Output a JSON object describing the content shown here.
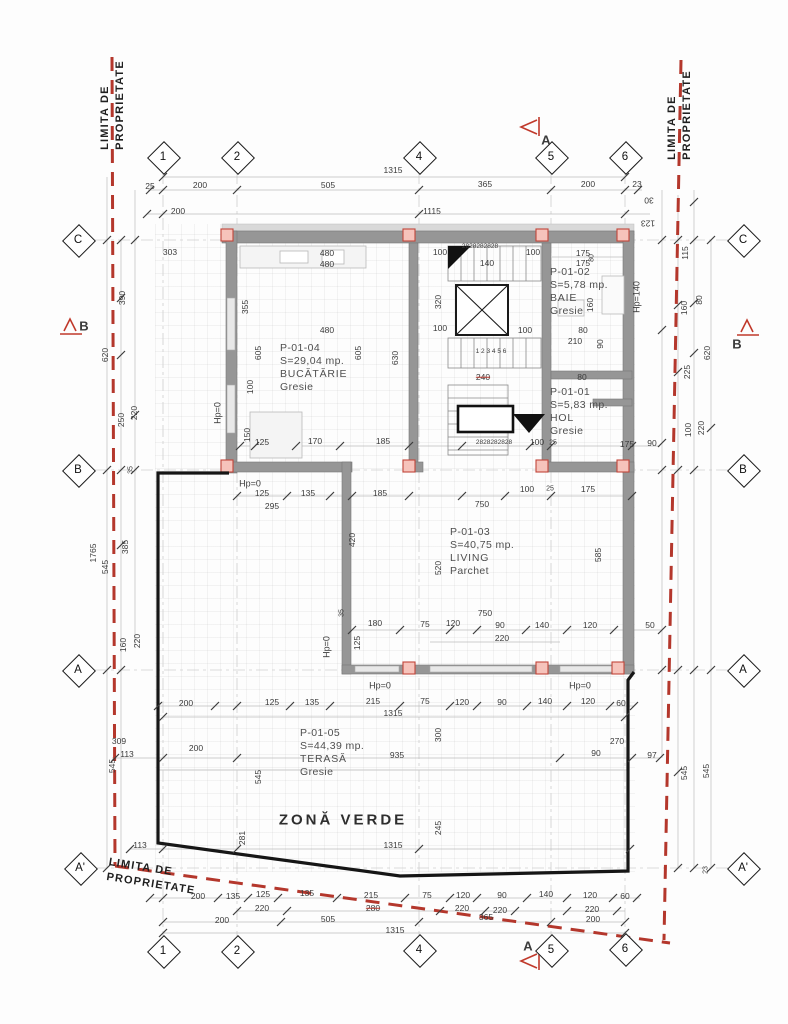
{
  "title": "floor-plan",
  "colors": {
    "property_line": "#b4372c",
    "section_marker": "#c0392b",
    "wall": "#969696",
    "column_fill": "#f6c3bb",
    "outline": "#161616"
  },
  "property_labels": [
    {
      "lines": [
        "LIMITA DE",
        "PROPRIETATE"
      ],
      "x": 113,
      "y": 105,
      "rot": -90,
      "name": "property-line-label-top-left"
    },
    {
      "lines": [
        "LIMITA DE",
        "PROPRIETATE"
      ],
      "x": 680,
      "y": 115,
      "rot": -90,
      "name": "property-line-label-top-right"
    },
    {
      "lines": [
        "LIMITA DE",
        "PROPRIETATE"
      ],
      "x": 152,
      "y": 877,
      "rot": 9,
      "name": "property-line-label-bottom-left"
    }
  ],
  "grid_bubbles": [
    {
      "id": "1",
      "x": 163,
      "y": 157,
      "pos": "top"
    },
    {
      "id": "2",
      "x": 237,
      "y": 157,
      "pos": "top"
    },
    {
      "id": "4",
      "x": 419,
      "y": 157,
      "pos": "top"
    },
    {
      "id": "5",
      "x": 551,
      "y": 157,
      "pos": "top"
    },
    {
      "id": "6",
      "x": 625,
      "y": 157,
      "pos": "top"
    },
    {
      "id": "1",
      "x": 163,
      "y": 951,
      "pos": "bottom"
    },
    {
      "id": "2",
      "x": 237,
      "y": 951,
      "pos": "bottom"
    },
    {
      "id": "4",
      "x": 419,
      "y": 950,
      "pos": "bottom"
    },
    {
      "id": "5",
      "x": 551,
      "y": 950,
      "pos": "bottom"
    },
    {
      "id": "6",
      "x": 625,
      "y": 949,
      "pos": "bottom"
    },
    {
      "id": "C",
      "x": 78,
      "y": 240,
      "pos": "left"
    },
    {
      "id": "B",
      "x": 78,
      "y": 470,
      "pos": "left"
    },
    {
      "id": "A",
      "x": 78,
      "y": 670,
      "pos": "left"
    },
    {
      "id": "A'",
      "x": 80,
      "y": 868,
      "pos": "left"
    },
    {
      "id": "C",
      "x": 743,
      "y": 240,
      "pos": "right"
    },
    {
      "id": "B",
      "x": 743,
      "y": 470,
      "pos": "right"
    },
    {
      "id": "A",
      "x": 743,
      "y": 670,
      "pos": "right"
    },
    {
      "id": "A'",
      "x": 743,
      "y": 868,
      "pos": "right"
    }
  ],
  "rooms": [
    {
      "id": "P-01-04",
      "area": "S=29,04 mp.",
      "name": "BUCĂTĂRIE",
      "finish": "Gresie",
      "x": 280,
      "y": 342
    },
    {
      "id": "P-01-02",
      "area": "S=5,78 mp.",
      "name": "BAIE",
      "finish": "Gresie",
      "x": 550,
      "y": 266
    },
    {
      "id": "P-01-01",
      "area": "S=5,83 mp.",
      "name": "HOL",
      "finish": "Gresie",
      "x": 550,
      "y": 386
    },
    {
      "id": "P-01-03",
      "area": "S=40,75 mp.",
      "name": "LIVING",
      "finish": "Parchet",
      "x": 450,
      "y": 526
    },
    {
      "id": "P-01-05",
      "area": "S=44,39 mp.",
      "name": "TERASĂ",
      "finish": "Gresie",
      "x": 300,
      "y": 727
    }
  ],
  "labels": [
    {
      "t": "25",
      "x": 150,
      "y": 186
    },
    {
      "t": "200",
      "x": 200,
      "y": 185
    },
    {
      "t": "505",
      "x": 328,
      "y": 185
    },
    {
      "t": "365",
      "x": 485,
      "y": 184
    },
    {
      "t": "200",
      "x": 588,
      "y": 184
    },
    {
      "t": "23",
      "x": 637,
      "y": 184
    },
    {
      "t": "1315",
      "x": 393,
      "y": 170
    },
    {
      "t": "200",
      "x": 178,
      "y": 211
    },
    {
      "t": "1115",
      "x": 432,
      "y": 211
    },
    {
      "t": "30",
      "x": 649,
      "y": 200,
      "r": 180
    },
    {
      "t": "123",
      "x": 648,
      "y": 223,
      "r": 180
    },
    {
      "t": "303",
      "x": 170,
      "y": 252
    },
    {
      "t": "390",
      "x": 122,
      "y": 298,
      "r": -90
    },
    {
      "t": "620",
      "x": 105,
      "y": 355,
      "r": -90
    },
    {
      "t": "250",
      "x": 121,
      "y": 420,
      "r": -90
    },
    {
      "t": "220",
      "x": 134,
      "y": 413,
      "r": -90
    },
    {
      "t": "35",
      "x": 131,
      "y": 470,
      "r": -90,
      "s": 7
    },
    {
      "t": "1765",
      "x": 93,
      "y": 553,
      "r": -90
    },
    {
      "t": "545",
      "x": 105,
      "y": 567,
      "r": -90
    },
    {
      "t": "385",
      "x": 125,
      "y": 547,
      "r": -90
    },
    {
      "t": "160",
      "x": 123,
      "y": 645,
      "r": -90
    },
    {
      "t": "220",
      "x": 137,
      "y": 641,
      "r": -90
    },
    {
      "t": "545",
      "x": 112,
      "y": 766,
      "r": -90
    },
    {
      "t": "309",
      "x": 119,
      "y": 741
    },
    {
      "t": "113",
      "x": 127,
      "y": 754
    },
    {
      "t": "113",
      "x": 140,
      "y": 845
    },
    {
      "t": "200",
      "x": 196,
      "y": 748
    },
    {
      "t": "281",
      "x": 242,
      "y": 838,
      "r": -90
    },
    {
      "t": "545",
      "x": 258,
      "y": 777,
      "r": -90
    },
    {
      "t": "115",
      "x": 685,
      "y": 253,
      "r": -90
    },
    {
      "t": "80",
      "x": 699,
      "y": 300,
      "r": -90
    },
    {
      "t": "160",
      "x": 684,
      "y": 308,
      "r": -90
    },
    {
      "t": "620",
      "x": 707,
      "y": 353,
      "r": -90
    },
    {
      "t": "225",
      "x": 687,
      "y": 372,
      "r": -90
    },
    {
      "t": "90",
      "x": 652,
      "y": 443
    },
    {
      "t": "100",
      "x": 688,
      "y": 430,
      "r": -90
    },
    {
      "t": "220",
      "x": 701,
      "y": 428,
      "r": -90
    },
    {
      "t": "60",
      "x": 621,
      "y": 703
    },
    {
      "t": "270",
      "x": 617,
      "y": 741
    },
    {
      "t": "97",
      "x": 652,
      "y": 755
    },
    {
      "t": "90",
      "x": 596,
      "y": 753
    },
    {
      "t": "545",
      "x": 684,
      "y": 773,
      "r": -90
    },
    {
      "t": "545",
      "x": 706,
      "y": 771,
      "r": -90
    },
    {
      "t": "23",
      "x": 706,
      "y": 870,
      "r": -90,
      "s": 7
    },
    {
      "t": "480",
      "x": 327,
      "y": 253
    },
    {
      "t": "480",
      "x": 327,
      "y": 264
    },
    {
      "t": "100",
      "x": 440,
      "y": 252
    },
    {
      "t": "355",
      "x": 245,
      "y": 307,
      "r": -90
    },
    {
      "t": "320",
      "x": 438,
      "y": 302,
      "r": -90
    },
    {
      "t": "480",
      "x": 327,
      "y": 330
    },
    {
      "t": "100",
      "x": 440,
      "y": 328
    },
    {
      "t": "605",
      "x": 258,
      "y": 353,
      "r": -90
    },
    {
      "t": "605",
      "x": 358,
      "y": 353,
      "r": -90
    },
    {
      "t": "630",
      "x": 395,
      "y": 358,
      "r": -90
    },
    {
      "t": "100",
      "x": 250,
      "y": 387,
      "r": -90
    },
    {
      "t": "150",
      "x": 247,
      "y": 435,
      "r": -90
    },
    {
      "t": "125",
      "x": 262,
      "y": 442
    },
    {
      "t": "170",
      "x": 315,
      "y": 441
    },
    {
      "t": "185",
      "x": 383,
      "y": 441
    },
    {
      "t": "Hp=0",
      "x": 218,
      "y": 413,
      "r": -90,
      "s": 9,
      "n": "hp-label"
    },
    {
      "t": "2828282828",
      "x": 480,
      "y": 247,
      "s": 6.5
    },
    {
      "t": "100",
      "x": 533,
      "y": 252
    },
    {
      "t": "140",
      "x": 487,
      "y": 263
    },
    {
      "t": "175",
      "x": 583,
      "y": 253
    },
    {
      "t": "175",
      "x": 583,
      "y": 263
    },
    {
      "t": "80",
      "x": 592,
      "y": 258,
      "r": -90,
      "s": 7
    },
    {
      "t": "160",
      "x": 590,
      "y": 305,
      "r": -90
    },
    {
      "t": "80",
      "x": 583,
      "y": 330
    },
    {
      "t": "210",
      "x": 575,
      "y": 341
    },
    {
      "t": "90",
      "x": 600,
      "y": 344,
      "r": -90
    },
    {
      "t": "100",
      "x": 525,
      "y": 330
    },
    {
      "t": "80",
      "x": 582,
      "y": 377
    },
    {
      "t": "240",
      "x": 483,
      "y": 377,
      "st": 1
    },
    {
      "t": "1 2 3 4 5 6",
      "x": 491,
      "y": 352,
      "s": 6.5
    },
    {
      "t": "2828282828",
      "x": 494,
      "y": 443,
      "s": 6.5
    },
    {
      "t": "100",
      "x": 537,
      "y": 442
    },
    {
      "t": "25",
      "x": 553,
      "y": 443,
      "s": 7
    },
    {
      "t": "175",
      "x": 627,
      "y": 444
    },
    {
      "t": "Hp=140",
      "x": 637,
      "y": 297,
      "r": -90,
      "s": 9,
      "n": "hp-label"
    },
    {
      "t": "Hp=0",
      "x": 250,
      "y": 484,
      "s": 9,
      "n": "hp-label"
    },
    {
      "t": "125",
      "x": 262,
      "y": 493
    },
    {
      "t": "135",
      "x": 308,
      "y": 493
    },
    {
      "t": "185",
      "x": 380,
      "y": 493
    },
    {
      "t": "100",
      "x": 527,
      "y": 489
    },
    {
      "t": "25",
      "x": 550,
      "y": 489,
      "s": 7
    },
    {
      "t": "175",
      "x": 588,
      "y": 489
    },
    {
      "t": "295",
      "x": 272,
      "y": 506
    },
    {
      "t": "750",
      "x": 482,
      "y": 504
    },
    {
      "t": "420",
      "x": 352,
      "y": 540,
      "r": -90
    },
    {
      "t": "520",
      "x": 438,
      "y": 568,
      "r": -90
    },
    {
      "t": "585",
      "x": 598,
      "y": 555,
      "r": -90
    },
    {
      "t": "750",
      "x": 485,
      "y": 613
    },
    {
      "t": "180",
      "x": 375,
      "y": 623
    },
    {
      "t": "75",
      "x": 425,
      "y": 624
    },
    {
      "t": "120",
      "x": 453,
      "y": 623
    },
    {
      "t": "90",
      "x": 500,
      "y": 625
    },
    {
      "t": "140",
      "x": 542,
      "y": 625
    },
    {
      "t": "120",
      "x": 590,
      "y": 625
    },
    {
      "t": "50",
      "x": 650,
      "y": 625
    },
    {
      "t": "220",
      "x": 502,
      "y": 638
    },
    {
      "t": "125",
      "x": 357,
      "y": 643,
      "r": -90
    },
    {
      "t": "35",
      "x": 342,
      "y": 613,
      "r": -90,
      "s": 7
    },
    {
      "t": "Hp=0",
      "x": 327,
      "y": 647,
      "r": -90,
      "s": 9,
      "n": "hp-label"
    },
    {
      "t": "Hp=0",
      "x": 380,
      "y": 686,
      "s": 9,
      "n": "hp-label"
    },
    {
      "t": "Hp=0",
      "x": 580,
      "y": 686,
      "s": 9,
      "n": "hp-label"
    },
    {
      "t": "200",
      "x": 186,
      "y": 703
    },
    {
      "t": "125",
      "x": 272,
      "y": 702
    },
    {
      "t": "135",
      "x": 312,
      "y": 702
    },
    {
      "t": "215",
      "x": 373,
      "y": 701
    },
    {
      "t": "75",
      "x": 425,
      "y": 701
    },
    {
      "t": "120",
      "x": 462,
      "y": 702
    },
    {
      "t": "90",
      "x": 502,
      "y": 702
    },
    {
      "t": "140",
      "x": 545,
      "y": 701
    },
    {
      "t": "120",
      "x": 588,
      "y": 701
    },
    {
      "t": "1315",
      "x": 393,
      "y": 713
    },
    {
      "t": "300",
      "x": 438,
      "y": 735,
      "r": -90
    },
    {
      "t": "935",
      "x": 397,
      "y": 755
    },
    {
      "t": "245",
      "x": 438,
      "y": 828,
      "r": -90
    },
    {
      "t": "1315",
      "x": 393,
      "y": 845
    },
    {
      "t": "ZONĂ VERDE",
      "x": 343,
      "y": 820,
      "n": "green-zone-label"
    },
    {
      "t": "200",
      "x": 198,
      "y": 896
    },
    {
      "t": "135",
      "x": 233,
      "y": 896
    },
    {
      "t": "125",
      "x": 263,
      "y": 894
    },
    {
      "t": "135",
      "x": 307,
      "y": 893
    },
    {
      "t": "215",
      "x": 371,
      "y": 895
    },
    {
      "t": "75",
      "x": 427,
      "y": 895
    },
    {
      "t": "120",
      "x": 463,
      "y": 895
    },
    {
      "t": "90",
      "x": 502,
      "y": 895
    },
    {
      "t": "140",
      "x": 546,
      "y": 894
    },
    {
      "t": "120",
      "x": 590,
      "y": 895
    },
    {
      "t": "60",
      "x": 625,
      "y": 896
    },
    {
      "t": "220",
      "x": 262,
      "y": 908
    },
    {
      "t": "280",
      "x": 373,
      "y": 908,
      "st": 1
    },
    {
      "t": "220",
      "x": 462,
      "y": 908
    },
    {
      "t": "220",
      "x": 500,
      "y": 910
    },
    {
      "t": "220",
      "x": 592,
      "y": 909
    },
    {
      "t": "200",
      "x": 222,
      "y": 920
    },
    {
      "t": "505",
      "x": 328,
      "y": 919
    },
    {
      "t": "365",
      "x": 486,
      "y": 917
    },
    {
      "t": "200",
      "x": 593,
      "y": 919
    },
    {
      "t": "1315",
      "x": 395,
      "y": 930
    },
    {
      "t": "A",
      "x": 546,
      "y": 140,
      "b": 1,
      "s": 13,
      "n": "section-a-top-letter"
    },
    {
      "t": "A",
      "x": 528,
      "y": 946,
      "b": 1,
      "s": 13,
      "n": "section-a-bottom-letter"
    },
    {
      "t": "B",
      "x": 84,
      "y": 326,
      "b": 1,
      "s": 13,
      "n": "section-b-left-letter"
    },
    {
      "t": "B",
      "x": 737,
      "y": 344,
      "b": 1,
      "s": 13,
      "n": "section-b-right-letter"
    }
  ]
}
